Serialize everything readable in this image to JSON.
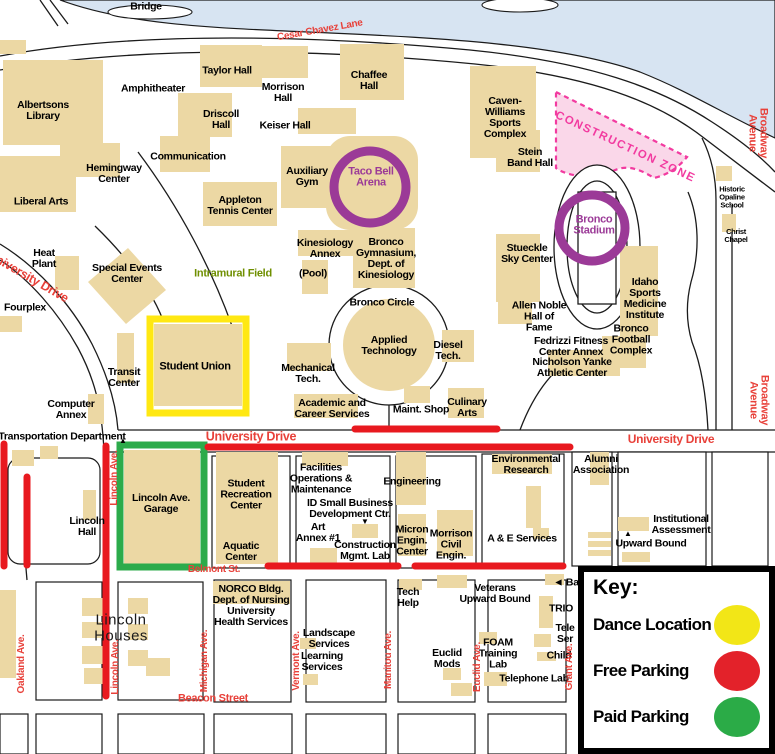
{
  "map": {
    "key": {
      "title": "Key:",
      "entries": [
        {
          "label": "Dance Location",
          "color": "#f2e617"
        },
        {
          "label": "Free Parking",
          "color": "#e3222a"
        },
        {
          "label": "Paid Parking",
          "color": "#2bab47"
        }
      ]
    },
    "colors": {
      "building": "#ecd8a4",
      "river": "#d7e4f2",
      "street_label": "#e8413a",
      "free_parking_line": "#e8191f",
      "dance_location_box": "#ffe812",
      "paid_parking_box": "#2cab4b",
      "arena_ring": "#9b3a97",
      "construction_zone": "#f23ba0",
      "field_label": "#6f8f00"
    },
    "labels": [
      {
        "text": "Bridge",
        "x": 146,
        "y": 7
      },
      {
        "text": "Albertsons\nLibrary",
        "x": 43,
        "y": 111
      },
      {
        "text": "Amphitheater",
        "x": 153,
        "y": 89
      },
      {
        "text": "Taylor Hall",
        "x": 227,
        "y": 71
      },
      {
        "text": "Driscoll\nHall",
        "x": 221,
        "y": 120
      },
      {
        "text": "Morrison\nHall",
        "x": 283,
        "y": 93
      },
      {
        "text": "Chaffee\nHall",
        "x": 369,
        "y": 81
      },
      {
        "text": "Keiser Hall",
        "x": 285,
        "y": 126
      },
      {
        "text": "Communication",
        "x": 188,
        "y": 157
      },
      {
        "text": "Hemingway\nCenter",
        "x": 114,
        "y": 174
      },
      {
        "text": "Liberal Arts",
        "x": 41,
        "y": 202
      },
      {
        "text": "Auxiliary\nGym",
        "x": 307,
        "y": 177
      },
      {
        "text": "Taco Bell\nArena",
        "x": 371,
        "y": 178,
        "type": "arena"
      },
      {
        "text": "Caven-\nWilliams\nSports\nComplex",
        "x": 505,
        "y": 118
      },
      {
        "text": "Stein\nBand Hall",
        "x": 530,
        "y": 158
      },
      {
        "text": "Appleton\nTennis Center",
        "x": 240,
        "y": 206
      },
      {
        "text": "Heat\nPlant",
        "x": 44,
        "y": 259
      },
      {
        "text": "Special Events\nCenter",
        "x": 127,
        "y": 274
      },
      {
        "text": "Intramural Field",
        "x": 233,
        "y": 274,
        "type": "field"
      },
      {
        "text": "Fourplex",
        "x": 25,
        "y": 308
      },
      {
        "text": "Kinesiology\nAnnex",
        "x": 325,
        "y": 249
      },
      {
        "text": "(Pool)",
        "x": 313,
        "y": 274
      },
      {
        "text": "Bronco\nGymnasium,\nDept. of\nKinesiology",
        "x": 386,
        "y": 259
      },
      {
        "text": "Bronco Circle",
        "x": 382,
        "y": 303
      },
      {
        "text": "Applied\nTechnology",
        "x": 389,
        "y": 346
      },
      {
        "text": "Diesel\nTech.",
        "x": 448,
        "y": 351
      },
      {
        "text": "Mechanical\nTech.",
        "x": 308,
        "y": 374
      },
      {
        "text": "Academic and\nCareer Services",
        "x": 332,
        "y": 409
      },
      {
        "text": "Maint. Shop",
        "x": 421,
        "y": 410
      },
      {
        "text": "Culinary\nArts",
        "x": 467,
        "y": 408
      },
      {
        "text": "Stueckle\nSky Center",
        "x": 527,
        "y": 254
      },
      {
        "text": "Bronco\nStadium",
        "x": 594,
        "y": 226,
        "type": "arena"
      },
      {
        "text": "Allen Noble\nHall of\nFame",
        "x": 539,
        "y": 317
      },
      {
        "text": "Fedrizzi Fitness\nCenter Annex",
        "x": 571,
        "y": 347
      },
      {
        "text": "Nicholson Yanke\nAthletic Center",
        "x": 572,
        "y": 368
      },
      {
        "text": "Bronco\nFootball\nComplex",
        "x": 631,
        "y": 340
      },
      {
        "text": "Idaho\nSports\nMedicine\nInstitute",
        "x": 645,
        "y": 299
      },
      {
        "text": "Historic\nOpaline\nSchool",
        "x": 732,
        "y": 197,
        "size": 7.5
      },
      {
        "text": "Christ\nChapel",
        "x": 736,
        "y": 236,
        "size": 7.5
      },
      {
        "text": "Transit\nCenter",
        "x": 124,
        "y": 378
      },
      {
        "text": "Student Union",
        "x": 195,
        "y": 367,
        "size": 11
      },
      {
        "text": "Computer\nAnnex",
        "x": 71,
        "y": 410
      },
      {
        "text": "Transportation Department",
        "x": 62,
        "y": 437
      },
      {
        "text": "Lincoln\nHall",
        "x": 87,
        "y": 527
      },
      {
        "text": "Lincoln Ave.\nGarage",
        "x": 161,
        "y": 504
      },
      {
        "text": "Student\nRecreation\nCenter",
        "x": 246,
        "y": 495
      },
      {
        "text": "Aquatic\nCenter",
        "x": 241,
        "y": 552
      },
      {
        "text": "Facilities\nOperations &\nMaintenance",
        "x": 321,
        "y": 479
      },
      {
        "text": "ID Small Business\nDevelopment Ctr.",
        "x": 350,
        "y": 509
      },
      {
        "text": "Art\nAnnex #1",
        "x": 318,
        "y": 533
      },
      {
        "text": "Construction\nMgmt. Lab",
        "x": 365,
        "y": 551
      },
      {
        "text": "Engineering",
        "x": 412,
        "y": 482
      },
      {
        "text": "Micron\nEngin.\nCenter",
        "x": 412,
        "y": 541
      },
      {
        "text": "Morrison\nCivil\nEngin.",
        "x": 451,
        "y": 545
      },
      {
        "text": "Environmental\nResearch",
        "x": 526,
        "y": 465
      },
      {
        "text": "A & E Services",
        "x": 522,
        "y": 539
      },
      {
        "text": "Alumni\nAssociation",
        "x": 601,
        "y": 465
      },
      {
        "text": "Institutional\nAssessment",
        "x": 681,
        "y": 525
      },
      {
        "text": "Upward Bound",
        "x": 651,
        "y": 544
      },
      {
        "text": "NORCO Bldg.\nDept. of Nursing\nUniversity\nHealth Services",
        "x": 251,
        "y": 606
      },
      {
        "text": "Landscape\nServices",
        "x": 329,
        "y": 639
      },
      {
        "text": "Learning\nServices",
        "x": 322,
        "y": 662
      },
      {
        "text": "Tech\nHelp",
        "x": 408,
        "y": 598
      },
      {
        "text": "Veterans\nUpward Bound",
        "x": 495,
        "y": 594
      },
      {
        "text": "Euclid\nMods",
        "x": 447,
        "y": 659
      },
      {
        "text": "FOAM\nTraining\nLab",
        "x": 498,
        "y": 654
      },
      {
        "text": "Telephone Lab",
        "x": 534,
        "y": 679
      },
      {
        "text": "TRIO",
        "x": 561,
        "y": 609
      },
      {
        "text": "Tele\nSer",
        "x": 565,
        "y": 634
      },
      {
        "text": "Child",
        "x": 559,
        "y": 656
      },
      {
        "text": "◄ Ba",
        "x": 566,
        "y": 583
      },
      {
        "text": "Lincoln\nHouses",
        "x": 121,
        "y": 628,
        "type": "place"
      },
      {
        "text": "CONSTRUCTION ZONE",
        "x": 625,
        "y": 148,
        "type": "construction",
        "rotate": 25
      },
      {
        "text": "Cesar Chavez Lane",
        "x": 320,
        "y": 31,
        "type": "street",
        "rotate": -10
      },
      {
        "text": "Broadway Avenue",
        "x": 757,
        "y": 133,
        "type": "street",
        "rotate": 90,
        "size": 11
      },
      {
        "text": "Broadway Avenue",
        "x": 758,
        "y": 400,
        "type": "street",
        "rotate": 90,
        "size": 11
      },
      {
        "text": "University Drive",
        "x": 28,
        "y": 277,
        "type": "street",
        "rotate": 30,
        "size": 12.5
      },
      {
        "text": "University Drive",
        "x": 251,
        "y": 437,
        "type": "street",
        "size": 12.5
      },
      {
        "text": "University Drive",
        "x": 671,
        "y": 439,
        "type": "street",
        "size": 12
      },
      {
        "text": "Belmont St.",
        "x": 214,
        "y": 570,
        "type": "street"
      },
      {
        "text": "Beacon Street",
        "x": 213,
        "y": 699,
        "type": "street",
        "size": 11
      },
      {
        "text": "Oakland Ave.",
        "x": 22,
        "y": 664,
        "type": "street",
        "rotate": -90
      },
      {
        "text": "Lincoln Ave.",
        "x": 115,
        "y": 478,
        "type": "street",
        "rotate": -90
      },
      {
        "text": "Lincoln Ave.",
        "x": 116,
        "y": 667,
        "type": "street",
        "rotate": -90
      },
      {
        "text": "Michigan Ave.",
        "x": 205,
        "y": 661,
        "type": "street",
        "rotate": -90
      },
      {
        "text": "Vermont Ave.",
        "x": 297,
        "y": 661,
        "type": "street",
        "rotate": -90
      },
      {
        "text": "Manitou Ave.",
        "x": 389,
        "y": 660,
        "type": "street",
        "rotate": -90
      },
      {
        "text": "Euclid Ave.",
        "x": 478,
        "y": 667,
        "type": "street",
        "rotate": -90
      },
      {
        "text": "Grant Ave.",
        "x": 570,
        "y": 667,
        "type": "street",
        "rotate": -90
      },
      {
        "text": "▼",
        "x": 365,
        "y": 522,
        "type": "mark"
      },
      {
        "text": "▲",
        "x": 628,
        "y": 534,
        "type": "mark"
      },
      {
        "text": "▲",
        "x": 123,
        "y": 441,
        "type": "mark"
      }
    ]
  }
}
